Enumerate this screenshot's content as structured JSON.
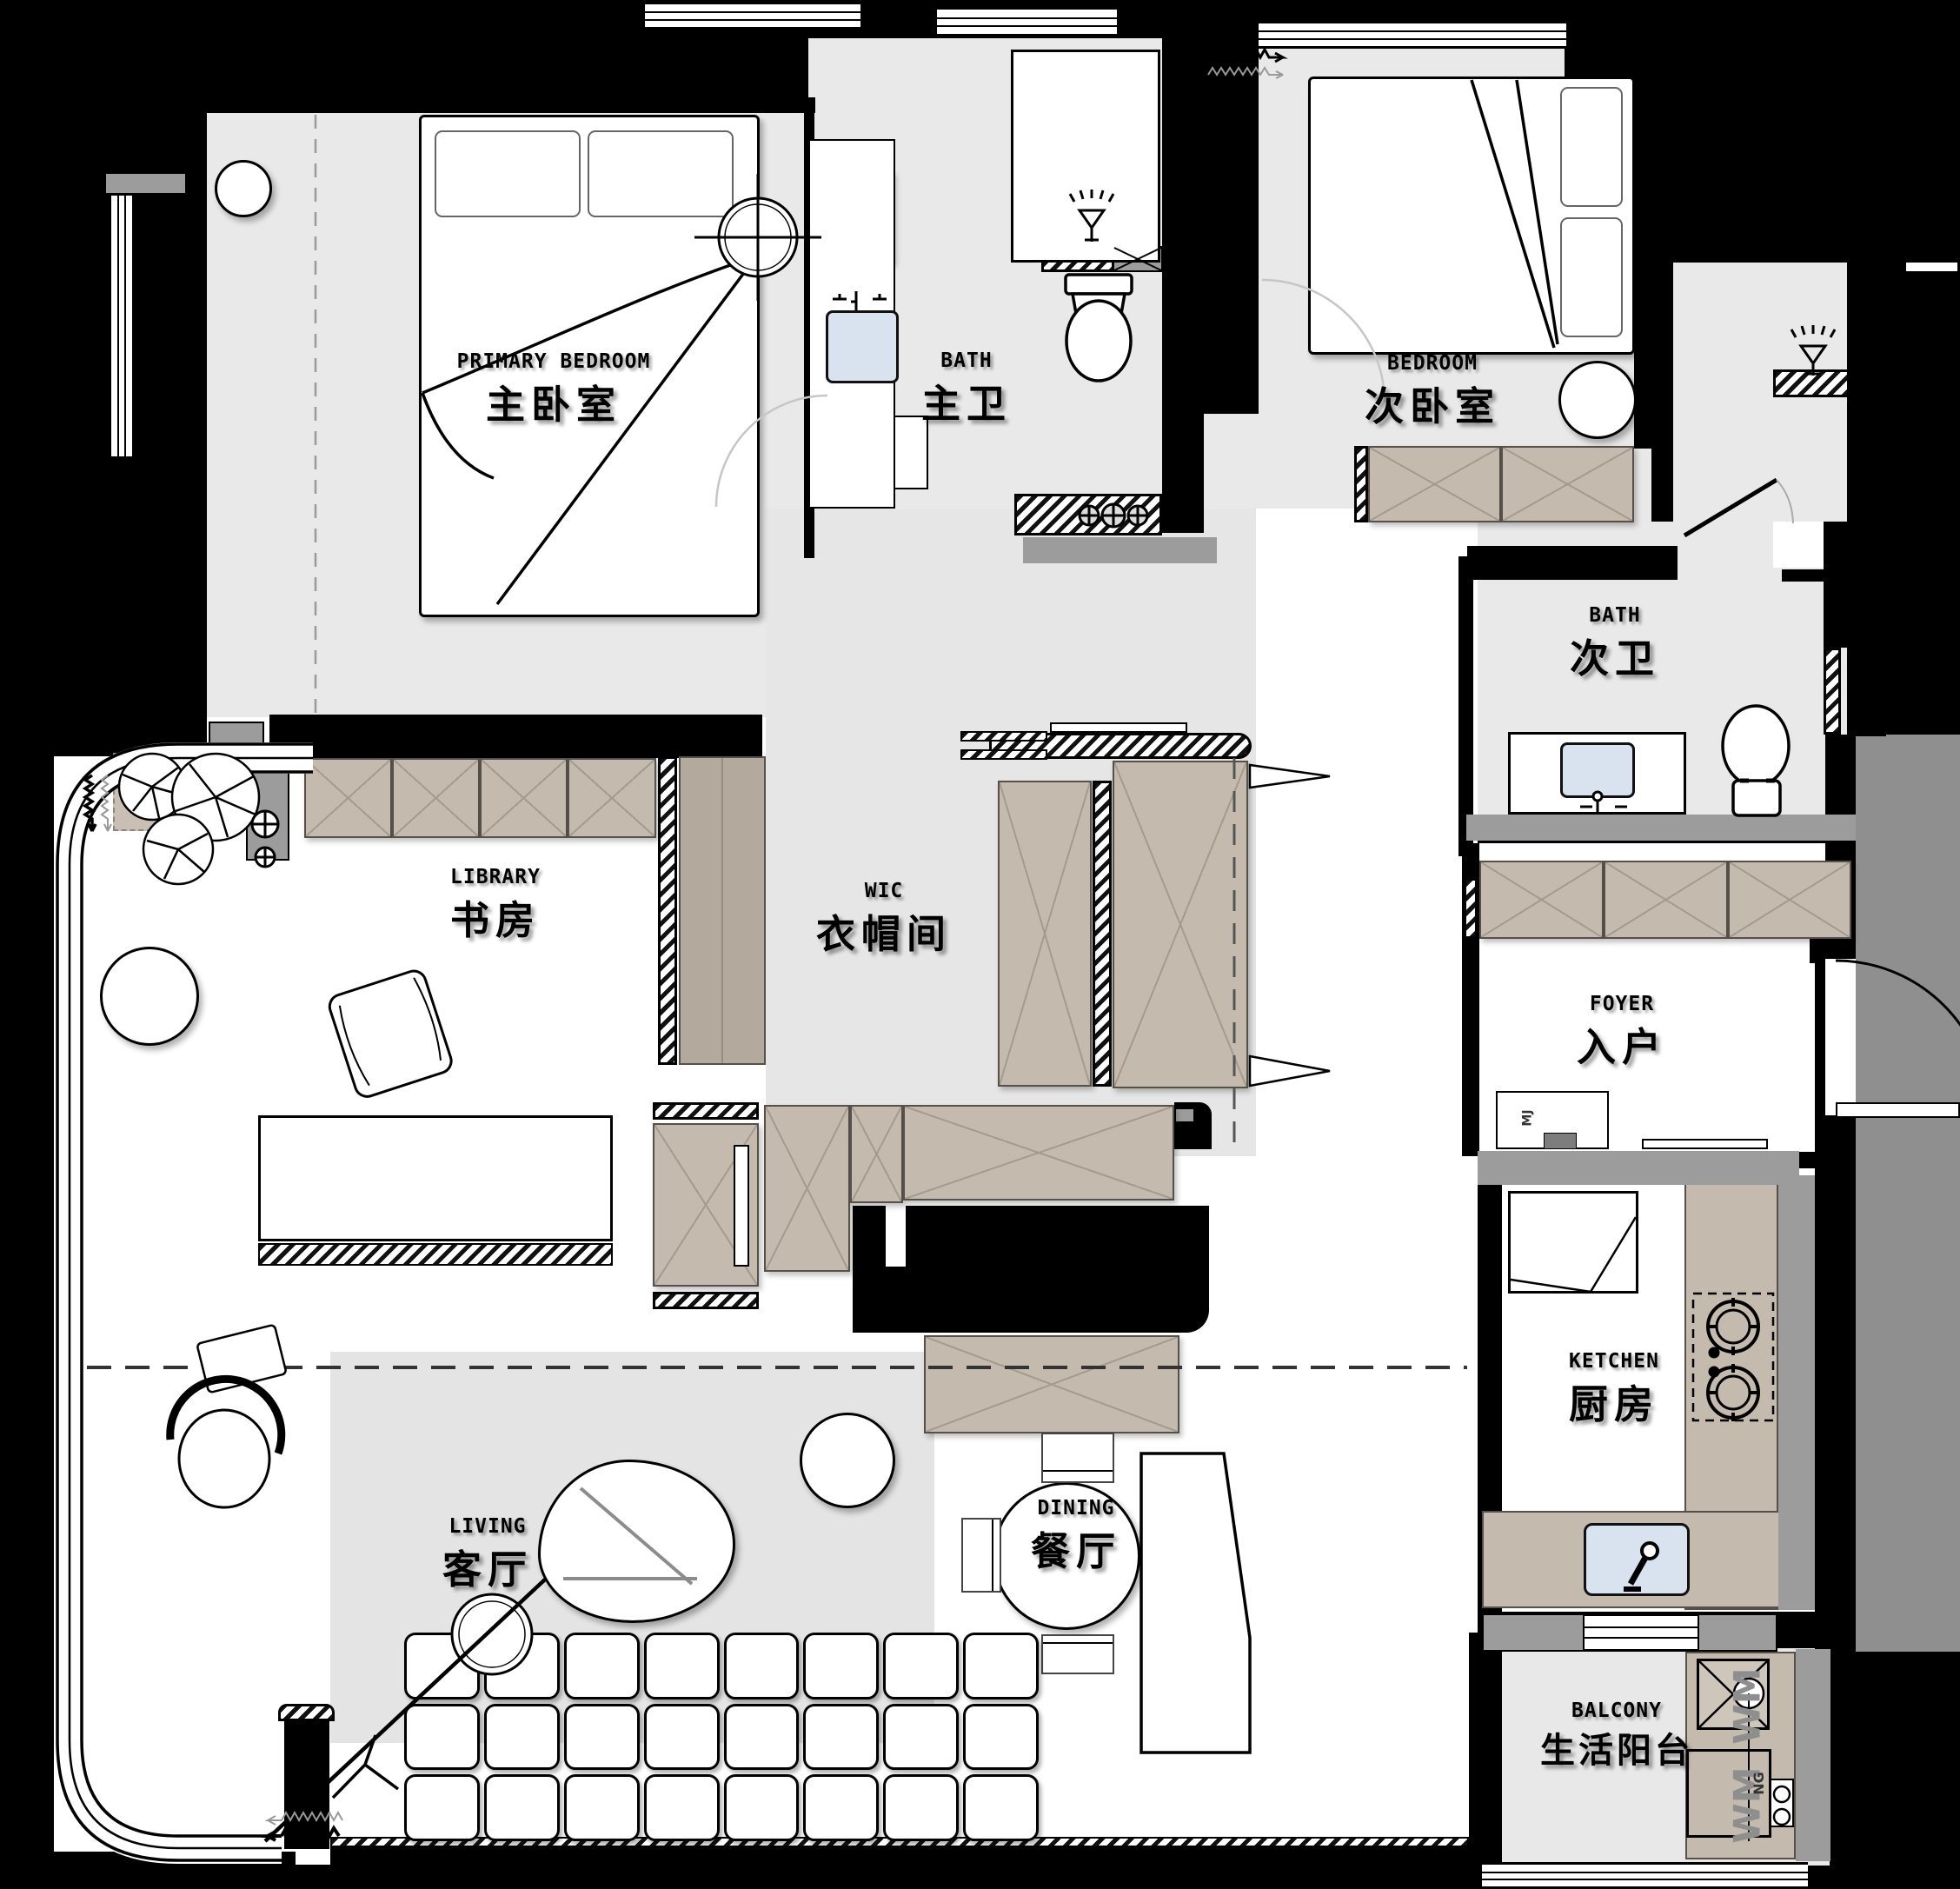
{
  "rooms": {
    "primary_bedroom": {
      "en": "PRIMARY BEDROOM",
      "zh": "主卧室"
    },
    "primary_bath": {
      "en": "BATH",
      "zh": "主卫"
    },
    "secondary_bedroom": {
      "en": "BEDROOM",
      "zh": "次卧室"
    },
    "secondary_bath": {
      "en": "BATH",
      "zh": "次卫"
    },
    "library": {
      "en": "LIBRARY",
      "zh": "书房"
    },
    "wic": {
      "en": "WIC",
      "zh": "衣帽间"
    },
    "foyer": {
      "en": "FOYER",
      "zh": "入户"
    },
    "kitchen": {
      "en": "KETCHEN",
      "zh": "厨房"
    },
    "living": {
      "en": "LIVING",
      "zh": "客厅"
    },
    "dining": {
      "en": "DINING",
      "zh": "餐厅"
    },
    "balcony": {
      "en": "BALCONY",
      "zh": "生活阳台"
    }
  },
  "small_labels": {
    "washer_top": "WM",
    "washer_bottom": "WM",
    "gas": "NG",
    "entry_cabinet": "MJ"
  },
  "colors": {
    "exterior": "#000000",
    "floor_gray": "#e9e9e9",
    "floor_white": "#ffffff",
    "cabinet_beige": "#c4baae",
    "counter_gray": "#9c9c9c",
    "outdoor_gray": "#8f8f8f",
    "sink_blue": "#d9e3ef"
  }
}
